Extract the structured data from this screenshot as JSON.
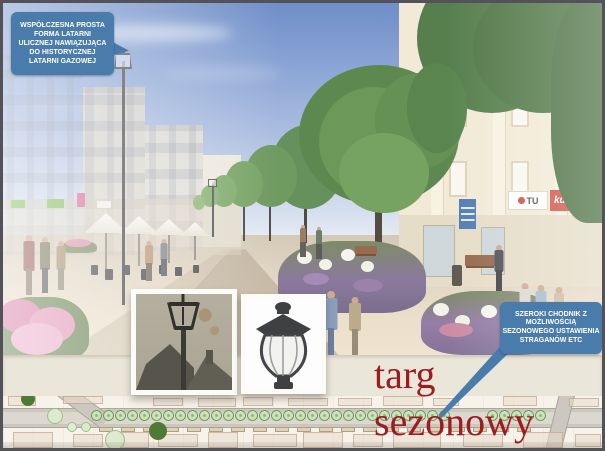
{
  "title": {
    "text": "targ sezonowy",
    "color": "#9d1c20"
  },
  "callouts": {
    "lantern": {
      "text": "WSPÓŁCZESNA PROSTA\nFORMA LATARNI\nULICZNEJ NAWIĄZUJĄCA\nDO HISTORYCZNEJ\nLATARNI GAZOWEJ",
      "bg": "#4a7cab"
    },
    "sidewalk": {
      "text": "SZEROKI CHODNIK Z\nMOŻLIWOŚCIĄ\nSEZONOWEGO USTAWIENIA\nSTRAGANÓW ETC",
      "bg": "#4a7cab"
    }
  },
  "render": {
    "signs": {
      "shop_tu": "TU",
      "shop_kupis": "kupis"
    }
  },
  "plan": {
    "tree_xs": [
      88,
      100,
      112,
      124,
      136,
      148,
      160,
      172,
      184,
      196,
      208,
      220,
      232,
      244,
      256,
      268,
      280,
      292,
      304,
      316,
      328,
      340,
      352,
      364,
      376,
      388,
      400,
      412,
      424,
      436,
      484,
      496,
      508,
      520,
      532
    ],
    "tree_y": 14,
    "stall_xs": [
      96,
      118,
      140,
      162,
      184,
      206,
      228,
      250,
      272,
      294,
      316,
      338,
      360,
      382,
      404,
      426,
      448,
      470,
      492,
      514
    ],
    "stall_y": 31,
    "blocks": [
      [
        5,
        0,
        28,
        10
      ],
      [
        60,
        0,
        40,
        8
      ],
      [
        150,
        2,
        30,
        8
      ],
      [
        195,
        2,
        38,
        9
      ],
      [
        240,
        1,
        30,
        9
      ],
      [
        285,
        2,
        40,
        8
      ],
      [
        335,
        2,
        34,
        8
      ],
      [
        380,
        0,
        40,
        10
      ],
      [
        430,
        2,
        26,
        8
      ],
      [
        500,
        0,
        34,
        10
      ],
      [
        566,
        2,
        30,
        9
      ],
      [
        10,
        36,
        40,
        16
      ],
      [
        70,
        38,
        30,
        13
      ],
      [
        110,
        36,
        36,
        16
      ],
      [
        155,
        38,
        40,
        13
      ],
      [
        205,
        36,
        30,
        16
      ],
      [
        250,
        38,
        44,
        13
      ],
      [
        300,
        36,
        40,
        16
      ],
      [
        350,
        38,
        30,
        13
      ],
      [
        390,
        36,
        48,
        16
      ],
      [
        460,
        38,
        40,
        13
      ],
      [
        520,
        36,
        40,
        16
      ],
      [
        572,
        38,
        26,
        13
      ]
    ],
    "pale_circles": [
      [
        44,
        12,
        16
      ],
      [
        64,
        26,
        10
      ],
      [
        78,
        26,
        10
      ]
    ],
    "big_pale": [
      102,
      34,
      20
    ],
    "solid_dark": [
      [
        146,
        26,
        18
      ],
      [
        18,
        -4,
        14
      ]
    ]
  }
}
